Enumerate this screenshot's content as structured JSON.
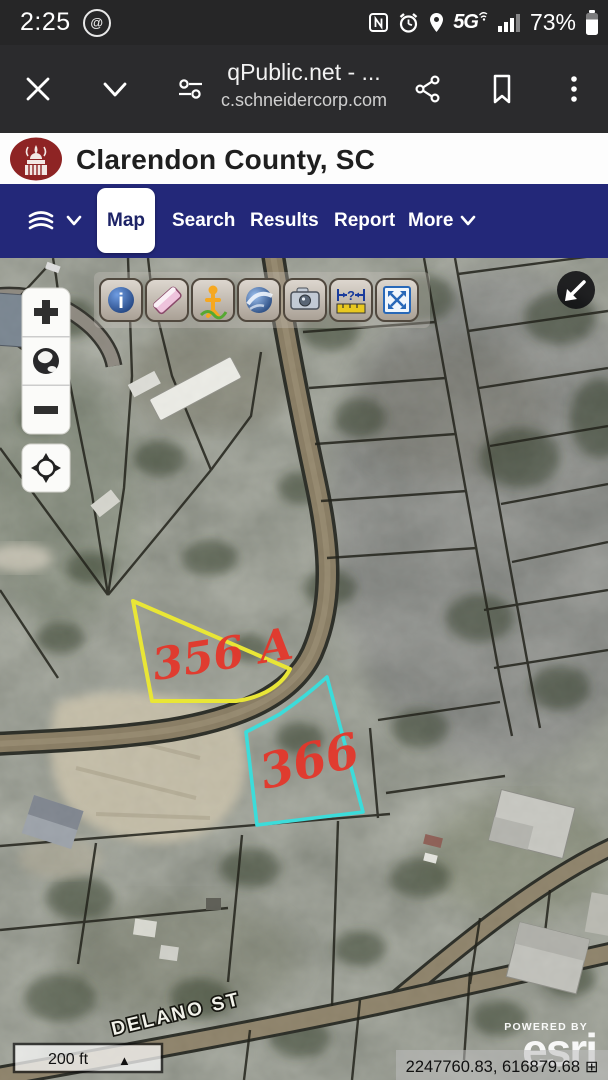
{
  "status_bar": {
    "time": "2:25",
    "battery_percent": "73%",
    "network_label": "5G",
    "icons": [
      "data-saver",
      "nfc",
      "alarm",
      "location",
      "wifi-call",
      "signal",
      "battery"
    ]
  },
  "browser": {
    "page_title": "qPublic.net - ...",
    "page_domain": "c.schneidercorp.com",
    "icons": [
      "close",
      "collapse-chevron",
      "controls",
      "share",
      "bookmark",
      "overflow-menu"
    ]
  },
  "site_header": {
    "title": "Clarendon County, SC",
    "logo_color": "#8e2424"
  },
  "nav": {
    "background": "#232879",
    "tabs": [
      {
        "label": "Map",
        "active": true
      },
      {
        "label": "Search",
        "active": false
      },
      {
        "label": "Results",
        "active": false
      },
      {
        "label": "Report",
        "active": false
      },
      {
        "label": "More",
        "active": false
      }
    ],
    "left_icons": [
      "layers",
      "chevron-down"
    ]
  },
  "map": {
    "toolbar_buttons": [
      "identify-info",
      "eraser",
      "street-view-pegman",
      "google-earth",
      "photo-attachment",
      "measure-distance",
      "zoom-to-extent"
    ],
    "zoom_controls": [
      "zoom-in",
      "full-extent-globe",
      "zoom-out",
      "my-location"
    ],
    "corner_button": "arrow-southwest",
    "parcels": [
      {
        "label": "356 A",
        "outline_color": "#e9e636"
      },
      {
        "label": "366",
        "outline_color": "#3cdcda"
      }
    ],
    "parcel_label_color": "#e4372b",
    "street_label": "DELANO ST",
    "scale": {
      "label": "200 ft",
      "icon": "▲"
    },
    "attribution": {
      "powered_by": "POWERED BY",
      "brand": "esri"
    },
    "coordinates": {
      "value": "2247760.83, 616879.68",
      "icon": "⊞"
    }
  }
}
